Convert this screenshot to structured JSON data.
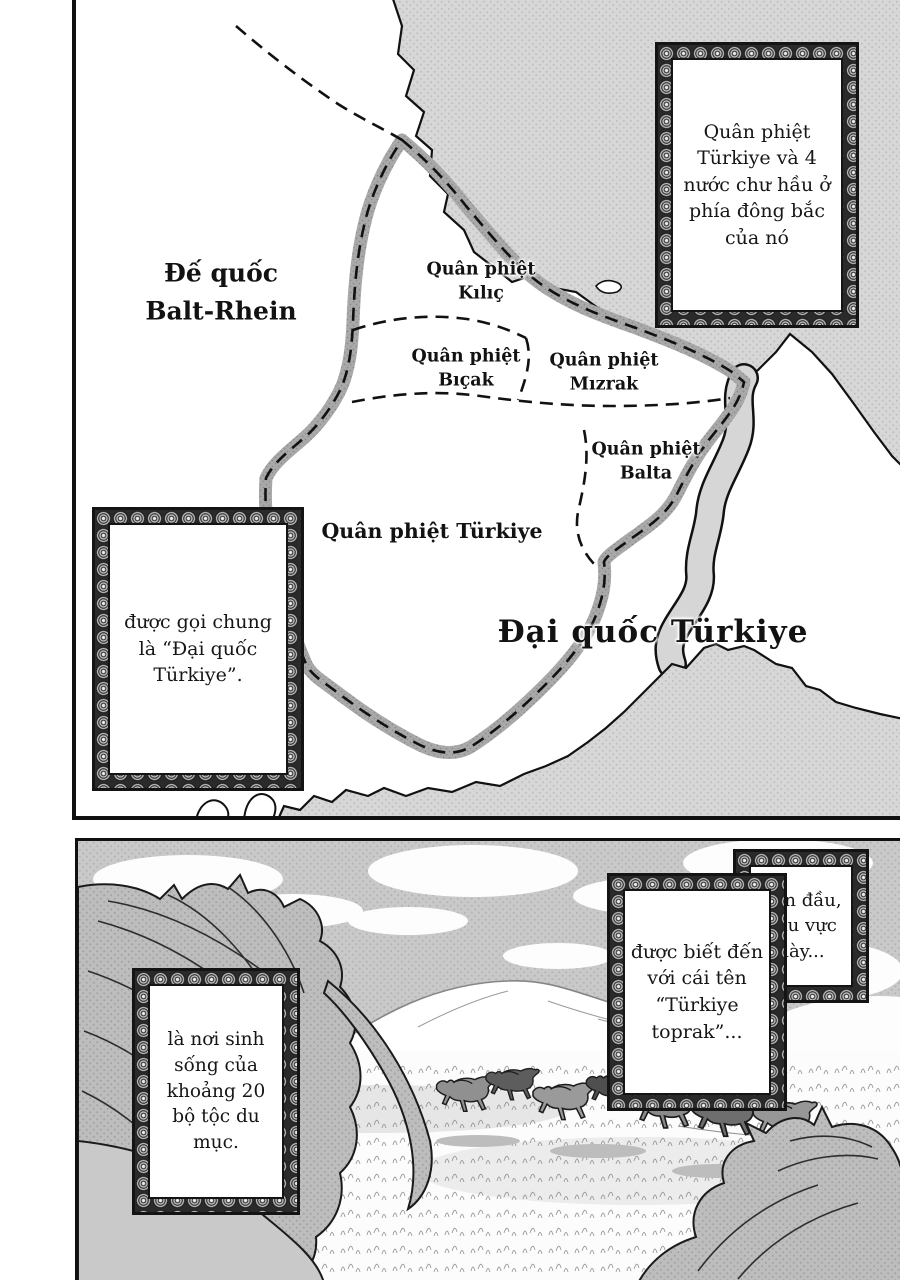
{
  "map_panel": {
    "empire": {
      "line1": "Đế quốc",
      "line2": "Balt-Rhein"
    },
    "regions": [
      {
        "line1": "Quân phiệt",
        "line2": "Kılıç"
      },
      {
        "line1": "Quân phiệt",
        "line2": "Bıçak"
      },
      {
        "line1": "Quân phiệt",
        "line2": "Mızrak"
      },
      {
        "line1": "Quân phiệt",
        "line2": "Balta"
      }
    ],
    "territory": "Quân phiệt Türkiye",
    "nation": "Đại quốc Türkiye",
    "caption_northeast": "Quân phiệt Türkiye và 4 nước chư hầu ở phía đông bắc của nó",
    "caption_west": "được gọi chung là “Đại quốc Türkiye”."
  },
  "field_panel": {
    "caption_intro": "Ban đầu, khu vực này...",
    "caption_known_as": "được biết đến với cái tên “Türkiye toprak”...",
    "caption_tribes": "là nơi sinh sống của khoảng 20 bộ tộc du mục."
  }
}
